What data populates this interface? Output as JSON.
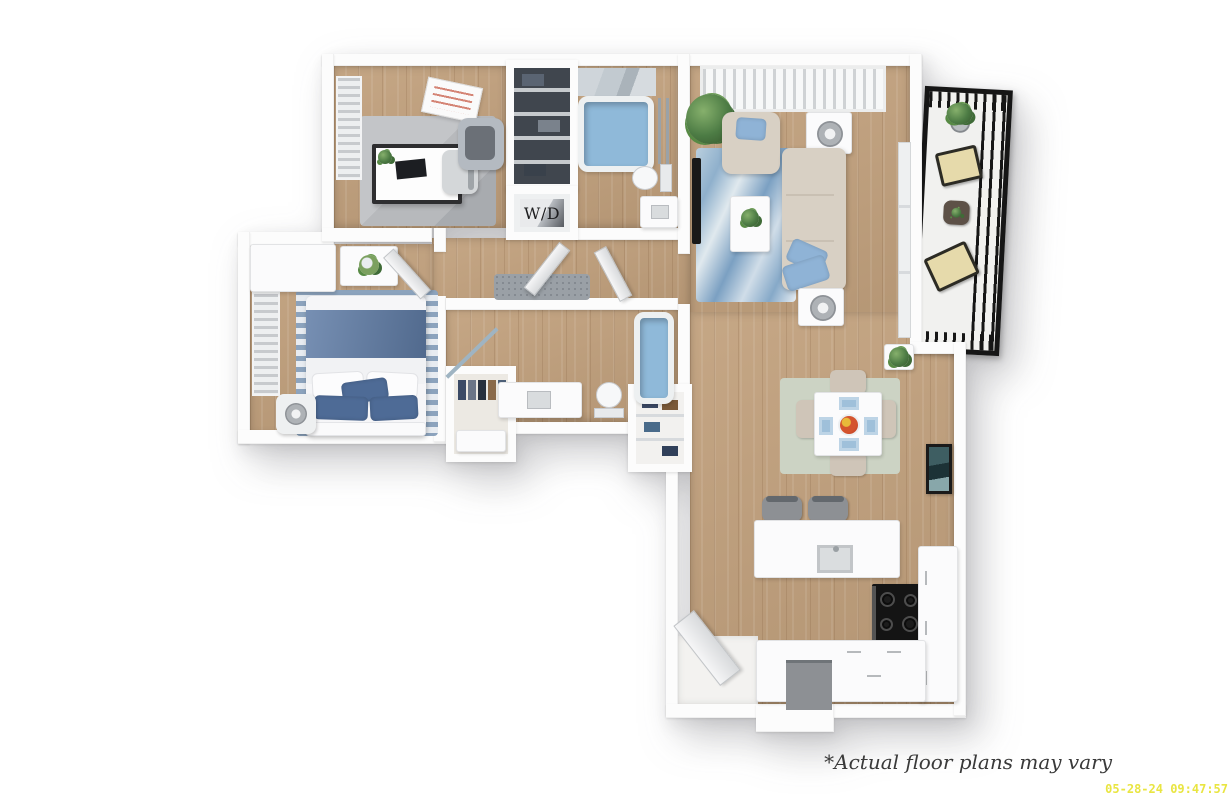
{
  "labels": {
    "washer_dryer": "W/D"
  },
  "footer": {
    "disclaimer": "*Actual floor plans may vary",
    "timestamp": "05-28-24 09:47:57"
  },
  "colors": {
    "wall": "#fcfcfc",
    "floor_wood": "#c1a07c",
    "rug_living_blue": "#8fb0cc",
    "rug_office_gray": "#b7b9bc",
    "rug_bedroom_stripe": "#8ca3bd",
    "rug_dining_sage": "#ccd3c4",
    "rug_hall_gray": "#9aa0a6",
    "sofa_beige": "#d8d0c4",
    "chair_beige": "#cfc5b8",
    "pillow_blue": "#8fb3d6",
    "bed_blue": "#5f7ca6",
    "pillow_dark_blue": "#4e6b96",
    "water_blue": "#8fb9d9",
    "marble_gray": "#c2cad0",
    "balcony_black": "#161616",
    "stove_black": "#141414",
    "appliance_gray": "#8d9094",
    "plant_green": "#4c7b44",
    "closet_dark": "#40464e",
    "label_dark": "#1d1d1f",
    "disclaimer_text": "#3a3a3a",
    "timestamp_yellow": "#e9e542"
  }
}
